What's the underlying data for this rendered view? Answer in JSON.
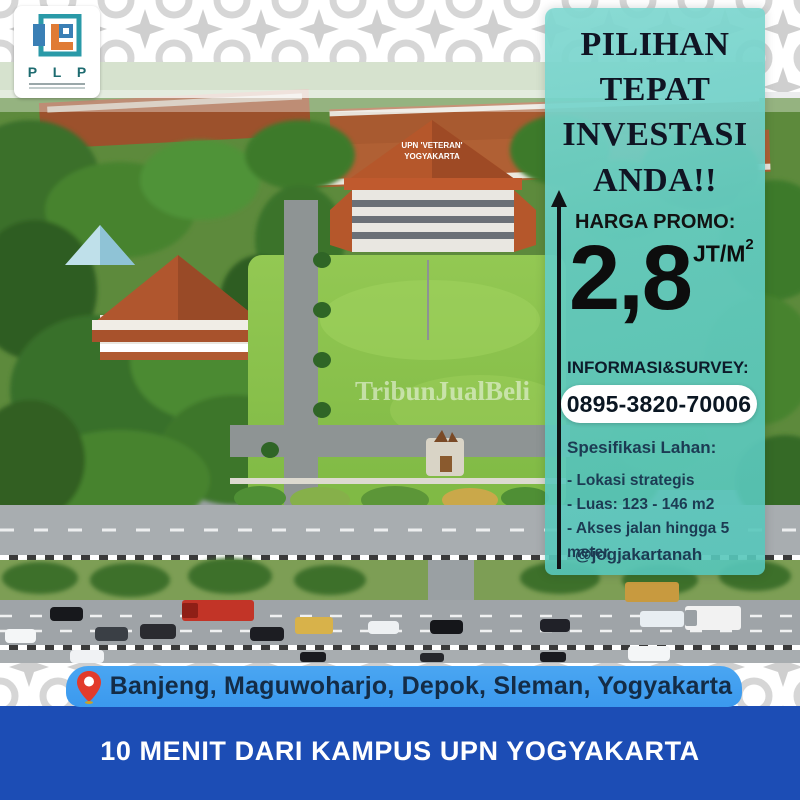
{
  "logo": {
    "text": "P L P"
  },
  "panel": {
    "headline_lines": [
      "PILIHAN",
      "TEPAT",
      "INVESTASI",
      "ANDA!!"
    ],
    "price_label": "HARGA PROMO:",
    "price_value": "2,8",
    "price_unit": "JT/M",
    "price_unit_sup": "2",
    "info_label": "INFORMASI&SURVEY:",
    "phone": "0895-3820-70006",
    "spec_title": "Spesifikasi Lahan:",
    "spec_items": [
      "- Lokasi strategis",
      "- Luas: 123 - 146 m2",
      "- Akses jalan hingga 5 meter"
    ],
    "social": "@jogjakartanah"
  },
  "photo": {
    "watermark": "TribunJualBeli",
    "roof_line1": "UPN 'VETERAN'",
    "roof_line2": "YOGYAKARTA"
  },
  "footer": {
    "location": "Banjeng, Maguwoharjo, Depok, Sleman, Yogyakarta",
    "tagline": "10 MENIT DARI KAMPUS UPN YOGYAKARTA"
  },
  "colors": {
    "panel_teal": "#5fc9bf",
    "royal_blue": "#1c4db5",
    "light_blue": "#3f9ff0",
    "pin_red": "#e23b2c",
    "headline_text": "#101423",
    "spec_text": "#1c3b53"
  }
}
